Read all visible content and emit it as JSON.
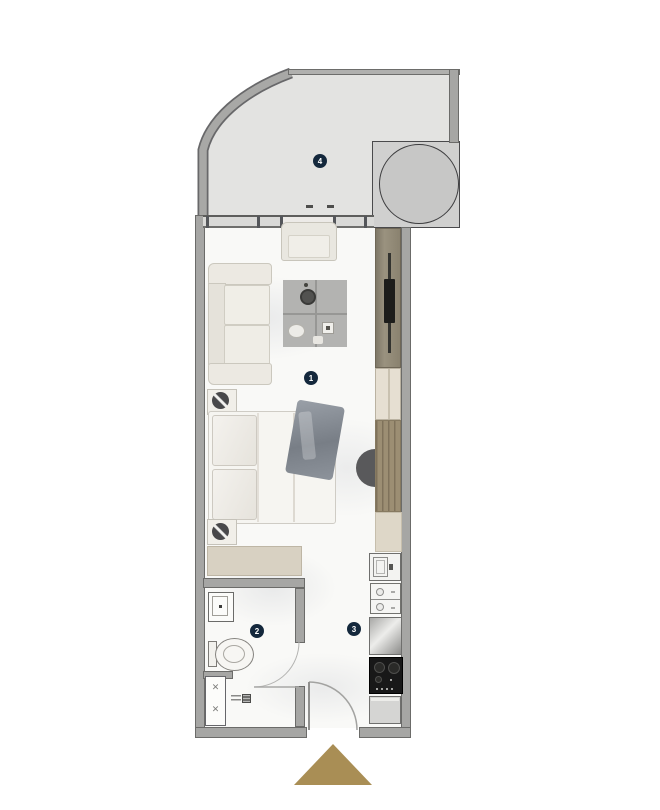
{
  "markers": {
    "living": {
      "label": "1"
    },
    "bathroom": {
      "label": "2"
    },
    "kitchen": {
      "label": "3"
    },
    "terrace": {
      "label": "4"
    }
  },
  "icons": {
    "shower_cross": "✕"
  },
  "colors": {
    "marker_bg": "#14283c",
    "marker_text": "#ffffff",
    "wall": "#a6a6a4",
    "wall_edge": "#6b6b69",
    "terrace_floor": "#e3e3e1",
    "terrace_table_zone": "#d0d0cf",
    "interior_floor": "#f9f9f7",
    "upholstery_cream": "#ece9e2",
    "rug_gray": "#b3b3b1",
    "wardrobe_wood": "#9c8e73",
    "tv_panel": "#8e8675",
    "tv_screen": "#1d1d1b",
    "cabinet_cream": "#ded7c8",
    "dresser_beige": "#d8d1c2",
    "steel_counter": "#c9c9c7",
    "cooktop_dark": "#181818",
    "entry_arrow": "#a98e55",
    "blanket_gray": "#8d939b"
  }
}
